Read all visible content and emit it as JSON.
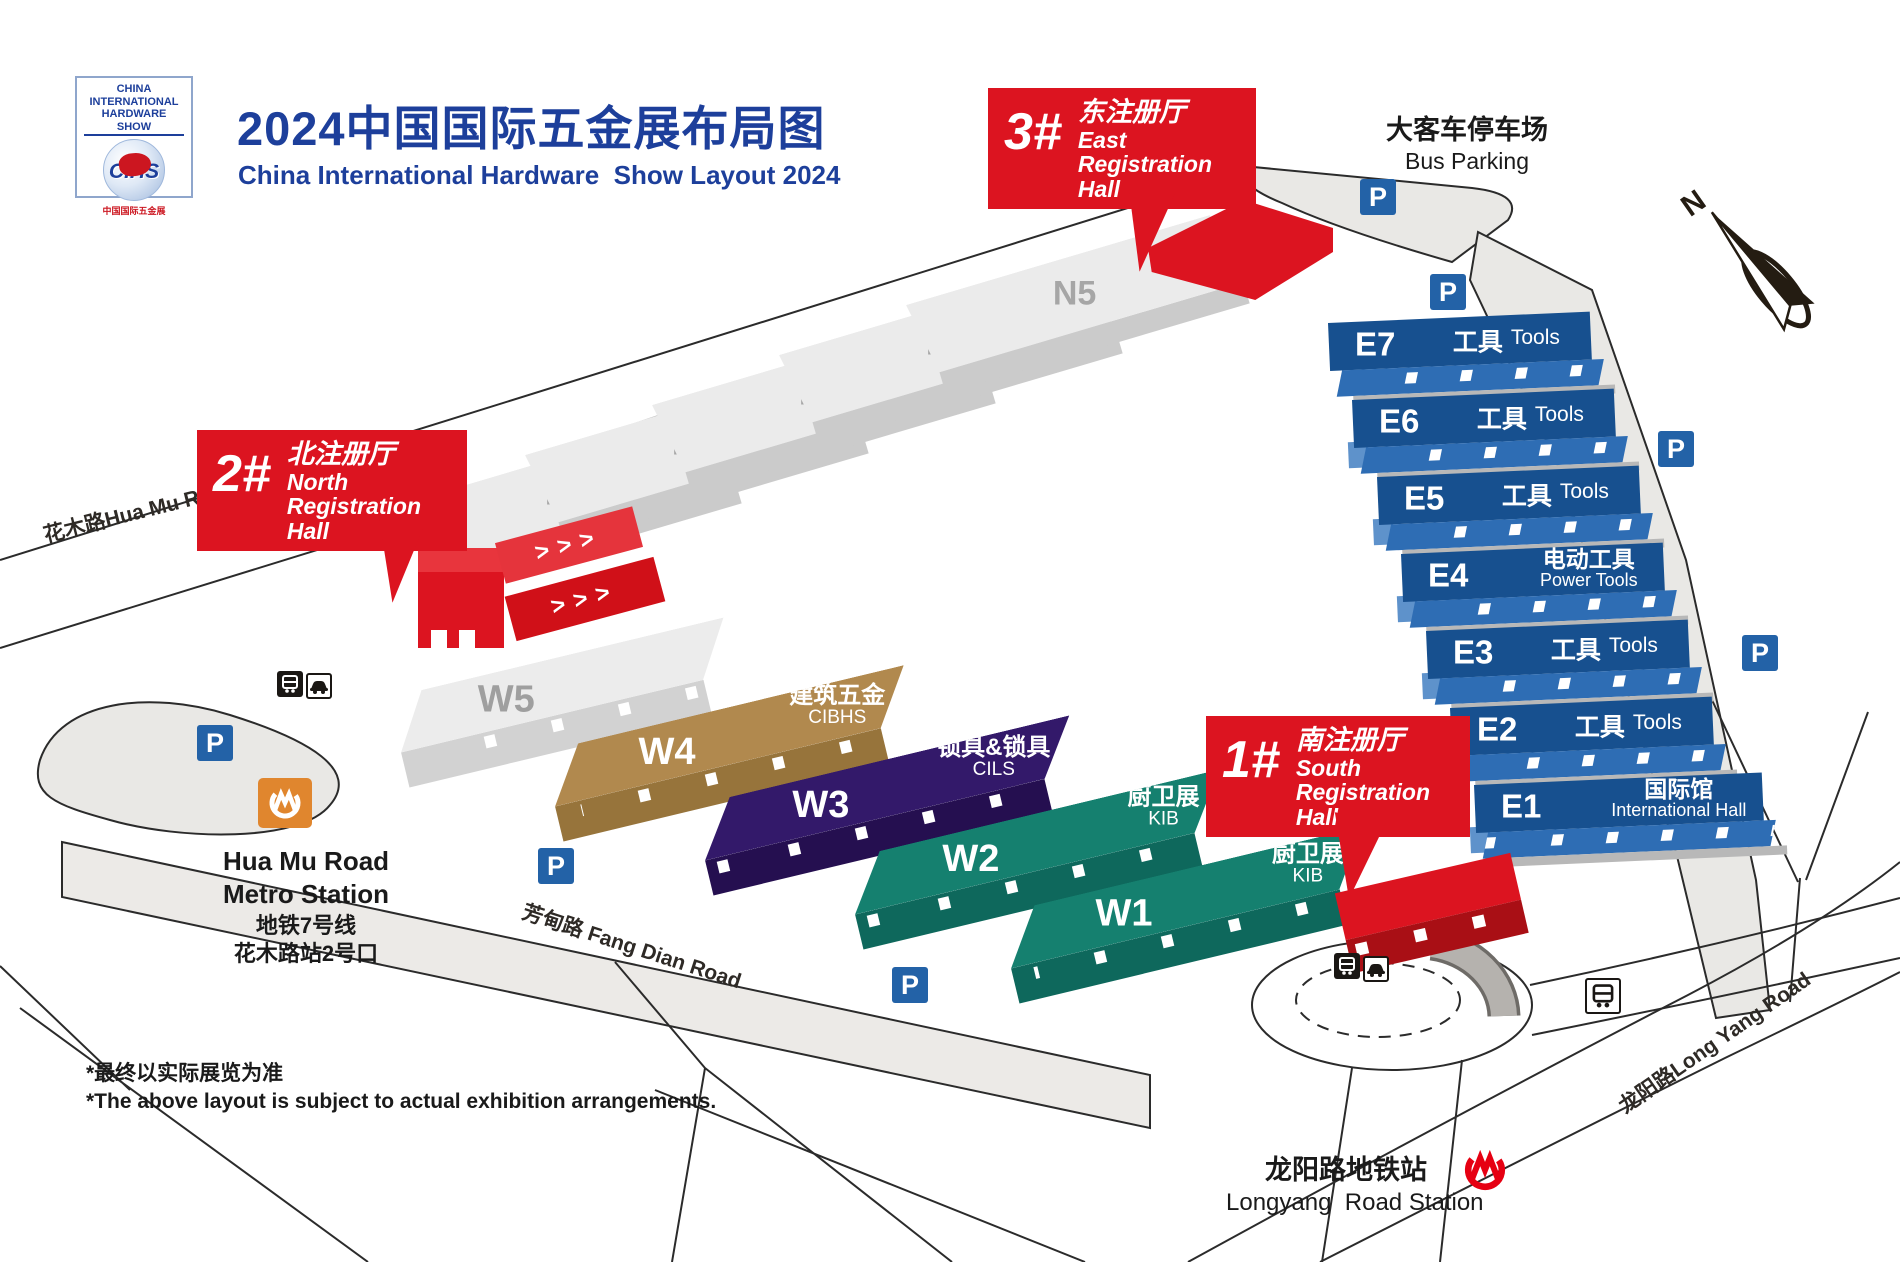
{
  "header": {
    "logo": {
      "line1": "CHINA INTERNATIONAL",
      "line2": "HARDWARE SHOW",
      "cihs": "CIHS",
      "zh": "中国国际五金展"
    },
    "title_zh": "2024中国国际五金展布局图",
    "title_en": "China International Hardware  Show Layout 2024"
  },
  "registration": {
    "east": {
      "num": "3#",
      "zh": "东注册厅",
      "en": "East Registration Hall"
    },
    "north": {
      "num": "2#",
      "zh": "北注册厅",
      "en": "North Registration Hall"
    },
    "south": {
      "num": "1#",
      "zh": "南注册厅",
      "en": "South Registration Hall"
    }
  },
  "halls": {
    "north": [
      {
        "id": "N1"
      },
      {
        "id": "N2"
      },
      {
        "id": "N3"
      },
      {
        "id": "N4"
      },
      {
        "id": "N5"
      }
    ],
    "east": [
      {
        "id": "E7",
        "zh": "工具",
        "en": "Tools"
      },
      {
        "id": "E6",
        "zh": "工具",
        "en": "Tools"
      },
      {
        "id": "E5",
        "zh": "工具",
        "en": "Tools"
      },
      {
        "id": "E4",
        "zh": "电动工具",
        "en": "Power Tools"
      },
      {
        "id": "E3",
        "zh": "工具",
        "en": "Tools"
      },
      {
        "id": "E2",
        "zh": "工具",
        "en": "Tools"
      },
      {
        "id": "E1",
        "zh": "国际馆",
        "en": "International Hall"
      }
    ],
    "west": [
      {
        "id": "W5"
      },
      {
        "id": "W4",
        "zh": "建筑五金",
        "en": "CIBHS"
      },
      {
        "id": "W3",
        "zh": "锁具&锁具",
        "en": "CILS"
      },
      {
        "id": "W2",
        "zh": "厨卫展",
        "en": "KIB"
      },
      {
        "id": "W1",
        "zh": "厨卫展",
        "en": "KIB"
      }
    ]
  },
  "landmarks": {
    "bus_parking": {
      "zh": "大客车停车场",
      "en": "Bus Parking"
    },
    "huamu_station": {
      "en1": "Hua Mu Road",
      "en2": "Metro Station",
      "zh1": "地铁7号线",
      "zh2": "花木路站2号口"
    },
    "longyang_station": {
      "zh": "龙阳路地铁站",
      "en": "Longyang  Road Station"
    },
    "parking_label": "P",
    "compass_n": "N",
    "chevrons": ">>>"
  },
  "roads": {
    "huamu": "花木路Hua Mu Road",
    "fangdian": "芳甸路 Fang Dian Road",
    "longyang": "龙阳路Long Yang Road"
  },
  "footer": {
    "line1": "*最终以实际展览为准",
    "line2": "*The above layout is subject to actual exhibition arrangements."
  },
  "colors": {
    "red": "#DC1420",
    "hall_blue": "#17508F",
    "hall_blue_front": "#2E6DB4",
    "teal": "#15806F",
    "purple": "#33196A",
    "tan": "#B1894E",
    "title_blue": "#1D3F9B",
    "parking_blue": "#2362A7",
    "metro_orange": "#E0862E",
    "metro_red": "#E60012",
    "gray_hall": "#EBEBEB",
    "road_gray": "#E9E8E5"
  }
}
